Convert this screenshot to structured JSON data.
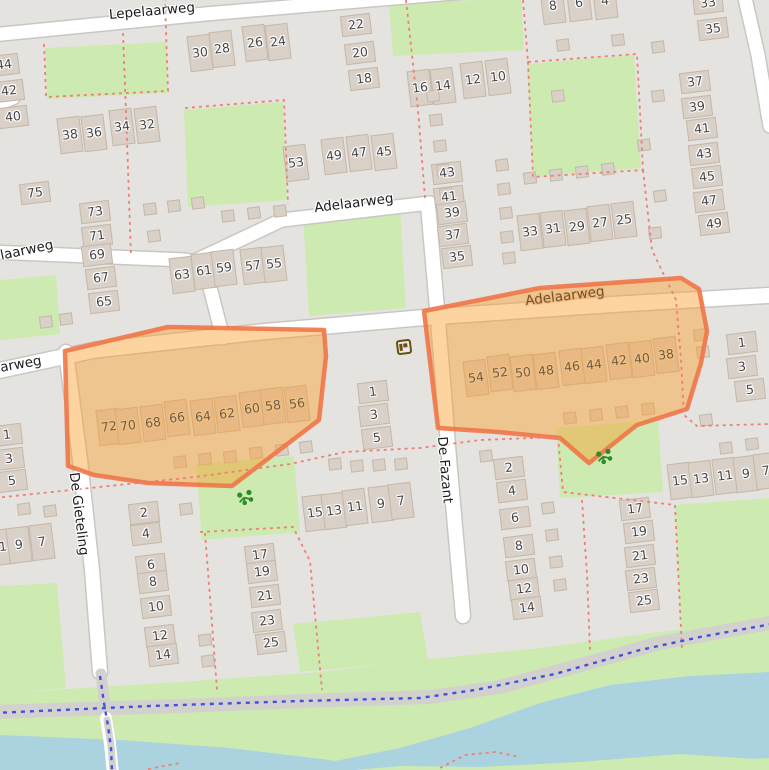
{
  "map": {
    "colors": {
      "bg": "#e4e3e0",
      "green": "#cdebb0",
      "water": "#aad3df",
      "building": "#d9d0c8",
      "building_stroke": "#c5b8a8",
      "road": "#ffffff",
      "road_casing": "#c9c7c3",
      "path_grey": "#d2d1cd",
      "dash_red": "#ee7f75",
      "dot_blue": "#4350dd",
      "orange_fill": "rgba(250,157,45,0.45)",
      "orange_stroke": "rgba(240,118,72,0.9)",
      "number": "#454545",
      "number_in_orange": "#6e5e45",
      "street": "#1c1c1c",
      "poi_brown": "#6b4f12",
      "playground_green": "#2e8b2b"
    },
    "street_labels": [
      {
        "t": "Lepelaarweg",
        "x": 152,
        "y": 12,
        "r": -5
      },
      {
        "t": "laarweg",
        "x": 27,
        "y": 251,
        "r": -12
      },
      {
        "t": "arweg",
        "x": 21,
        "y": 365,
        "r": -10
      },
      {
        "t": "Adelaarweg",
        "x": 354,
        "y": 204,
        "r": -7
      },
      {
        "t": "Adelaarweg",
        "x": 565,
        "y": 297,
        "r": -7,
        "o": 1
      },
      {
        "t": "De Gieteling",
        "x": 78,
        "y": 514,
        "r": 83
      },
      {
        "t": "De Fazant",
        "x": 444,
        "y": 470,
        "r": 85
      }
    ],
    "house_numbers": [
      [
        "44",
        4,
        65,
        "v",
        0
      ],
      [
        "42",
        9,
        91,
        "v",
        0
      ],
      [
        "40",
        13,
        117,
        "v",
        0
      ],
      [
        "38",
        70,
        135,
        "h",
        0
      ],
      [
        "36",
        94,
        133,
        "h",
        0
      ],
      [
        "34",
        122,
        127,
        "h",
        0
      ],
      [
        "32",
        147,
        125,
        "h",
        0
      ],
      [
        "30",
        200,
        53,
        "h",
        0
      ],
      [
        "28",
        222,
        49,
        "h",
        0
      ],
      [
        "26",
        255,
        43,
        "h",
        0
      ],
      [
        "24",
        278,
        42,
        "h",
        0
      ],
      [
        "22",
        356,
        25,
        "v",
        0
      ],
      [
        "20",
        360,
        53,
        "v",
        0
      ],
      [
        "18",
        364,
        79,
        "v",
        0
      ],
      [
        "75",
        35,
        193,
        "v",
        0
      ],
      [
        "73",
        95,
        212,
        "v",
        0
      ],
      [
        "71",
        97,
        236,
        "v",
        0
      ],
      [
        "69",
        97,
        255,
        "v",
        0
      ],
      [
        "67",
        101,
        278,
        "v",
        0
      ],
      [
        "65",
        104,
        302,
        "v",
        0
      ],
      [
        "63",
        182,
        275,
        "h",
        0
      ],
      [
        "61",
        204,
        271,
        "h",
        0
      ],
      [
        "59",
        224,
        268,
        "h",
        0
      ],
      [
        "57",
        253,
        266,
        "h",
        0
      ],
      [
        "55",
        274,
        264,
        "h",
        0
      ],
      [
        "53",
        296,
        163,
        "h",
        0
      ],
      [
        "49",
        334,
        156,
        "h",
        0
      ],
      [
        "47",
        359,
        153,
        "h",
        0
      ],
      [
        "45",
        384,
        152,
        "h",
        0
      ],
      [
        "16",
        420,
        88,
        "h",
        0
      ],
      [
        "14",
        443,
        86,
        "h",
        0
      ],
      [
        "12",
        473,
        80,
        "h",
        0
      ],
      [
        "10",
        498,
        77,
        "h",
        0
      ],
      [
        "8",
        553,
        6,
        "h",
        0
      ],
      [
        "6",
        579,
        3,
        "h",
        0
      ],
      [
        "4",
        605,
        1,
        "h",
        0
      ],
      [
        "43",
        447,
        173,
        "v",
        0
      ],
      [
        "41",
        449,
        197,
        "v",
        0
      ],
      [
        "39",
        452,
        213,
        "v",
        0
      ],
      [
        "37",
        453,
        235,
        "v",
        0
      ],
      [
        "35",
        457,
        257,
        "v",
        0
      ],
      [
        "33",
        530,
        232,
        "h",
        0
      ],
      [
        "31",
        553,
        229,
        "h",
        0
      ],
      [
        "29",
        577,
        227,
        "h",
        0
      ],
      [
        "27",
        600,
        223,
        "h",
        0
      ],
      [
        "25",
        624,
        220,
        "h",
        0
      ],
      [
        "33",
        708,
        3,
        "v",
        0
      ],
      [
        "35",
        713,
        29,
        "v",
        0
      ],
      [
        "37",
        695,
        82,
        "v",
        0
      ],
      [
        "39",
        697,
        107,
        "v",
        0
      ],
      [
        "41",
        702,
        129,
        "v",
        0
      ],
      [
        "43",
        704,
        154,
        "v",
        0
      ],
      [
        "45",
        707,
        177,
        "v",
        0
      ],
      [
        "47",
        709,
        201,
        "v",
        0
      ],
      [
        "49",
        714,
        224,
        "v",
        0
      ],
      [
        "72",
        109,
        427,
        "h",
        1
      ],
      [
        "70",
        128,
        426,
        "h",
        1
      ],
      [
        "68",
        153,
        423,
        "h",
        1
      ],
      [
        "66",
        177,
        418,
        "h",
        1
      ],
      [
        "64",
        203,
        417,
        "h",
        1
      ],
      [
        "62",
        227,
        414,
        "h",
        1
      ],
      [
        "60",
        252,
        409,
        "h",
        1
      ],
      [
        "58",
        273,
        406,
        "h",
        1
      ],
      [
        "56",
        297,
        404,
        "h",
        1
      ],
      [
        "54",
        476,
        378,
        "h",
        1
      ],
      [
        "52",
        500,
        373,
        "h",
        1
      ],
      [
        "50",
        523,
        373,
        "h",
        1
      ],
      [
        "48",
        546,
        371,
        "h",
        1
      ],
      [
        "46",
        572,
        367,
        "h",
        1
      ],
      [
        "44",
        594,
        365,
        "h",
        1
      ],
      [
        "42",
        619,
        361,
        "h",
        1
      ],
      [
        "40",
        642,
        359,
        "h",
        1
      ],
      [
        "38",
        666,
        355,
        "h",
        1
      ],
      [
        "1",
        373,
        392,
        "v",
        0
      ],
      [
        "3",
        374,
        415,
        "v",
        0
      ],
      [
        "5",
        377,
        438,
        "v",
        0
      ],
      [
        "1",
        742,
        343,
        "v",
        0
      ],
      [
        "3",
        742,
        367,
        "v",
        0
      ],
      [
        "5",
        750,
        390,
        "v",
        0
      ],
      [
        "1",
        7,
        435,
        "v",
        0
      ],
      [
        "3",
        9,
        459,
        "v",
        0
      ],
      [
        "5",
        12,
        481,
        "v",
        0
      ],
      [
        "1",
        3,
        547,
        "h",
        0
      ],
      [
        "9",
        19,
        545,
        "h",
        0
      ],
      [
        "7",
        42,
        542,
        "h",
        0
      ],
      [
        "2",
        144,
        513,
        "v",
        0
      ],
      [
        "4",
        146,
        534,
        "v",
        0
      ],
      [
        "6",
        151,
        565,
        "v",
        0
      ],
      [
        "8",
        153,
        582,
        "v",
        0
      ],
      [
        "10",
        156,
        607,
        "v",
        0
      ],
      [
        "12",
        160,
        636,
        "v",
        0
      ],
      [
        "14",
        163,
        655,
        "v",
        0
      ],
      [
        "15",
        315,
        513,
        "h",
        0
      ],
      [
        "13",
        334,
        511,
        "h",
        0
      ],
      [
        "11",
        355,
        507,
        "h",
        0
      ],
      [
        "9",
        381,
        504,
        "h",
        0
      ],
      [
        "7",
        401,
        501,
        "h",
        0
      ],
      [
        "17",
        260,
        555,
        "v",
        0
      ],
      [
        "19",
        262,
        572,
        "v",
        0
      ],
      [
        "21",
        265,
        596,
        "v",
        0
      ],
      [
        "23",
        267,
        621,
        "v",
        0
      ],
      [
        "25",
        271,
        643,
        "v",
        0
      ],
      [
        "2",
        509,
        468,
        "v",
        0
      ],
      [
        "4",
        512,
        491,
        "v",
        0
      ],
      [
        "6",
        515,
        518,
        "v",
        0
      ],
      [
        "8",
        519,
        546,
        "v",
        0
      ],
      [
        "10",
        521,
        570,
        "v",
        0
      ],
      [
        "12",
        524,
        589,
        "v",
        0
      ],
      [
        "14",
        527,
        608,
        "v",
        0
      ],
      [
        "17",
        635,
        509,
        "v",
        0
      ],
      [
        "19",
        639,
        532,
        "v",
        0
      ],
      [
        "21",
        640,
        556,
        "v",
        0
      ],
      [
        "23",
        641,
        579,
        "v",
        0
      ],
      [
        "25",
        644,
        601,
        "v",
        0
      ],
      [
        "15",
        680,
        481,
        "h",
        0
      ],
      [
        "13",
        701,
        479,
        "h",
        0
      ],
      [
        "11",
        725,
        476,
        "h",
        0
      ],
      [
        "9",
        746,
        474,
        "h",
        0
      ],
      [
        "7",
        766,
        471,
        "h",
        0
      ]
    ],
    "sheds": [
      [
        150,
        209
      ],
      [
        174,
        206
      ],
      [
        198,
        203
      ],
      [
        228,
        216
      ],
      [
        254,
        213
      ],
      [
        280,
        211
      ],
      [
        154,
        236
      ],
      [
        433,
        96
      ],
      [
        436,
        120
      ],
      [
        440,
        146
      ],
      [
        443,
        170
      ],
      [
        446,
        194
      ],
      [
        563,
        45
      ],
      [
        618,
        40
      ],
      [
        658,
        47
      ],
      [
        658,
        96
      ],
      [
        558,
        96
      ],
      [
        644,
        145
      ],
      [
        660,
        196
      ],
      [
        655,
        233
      ],
      [
        530,
        178
      ],
      [
        556,
        175
      ],
      [
        582,
        172
      ],
      [
        608,
        169
      ],
      [
        502,
        165
      ],
      [
        504,
        189
      ],
      [
        506,
        213
      ],
      [
        507,
        237
      ],
      [
        509,
        258
      ],
      [
        335,
        464
      ],
      [
        357,
        466
      ],
      [
        379,
        465
      ],
      [
        401,
        464
      ],
      [
        180,
        462
      ],
      [
        205,
        459
      ],
      [
        230,
        457
      ],
      [
        256,
        453
      ],
      [
        282,
        450
      ],
      [
        306,
        447
      ],
      [
        570,
        418
      ],
      [
        596,
        415
      ],
      [
        622,
        412
      ],
      [
        648,
        409
      ],
      [
        700,
        335
      ],
      [
        703,
        352
      ],
      [
        726,
        448
      ],
      [
        752,
        444
      ],
      [
        706,
        420
      ],
      [
        24,
        509
      ],
      [
        50,
        511
      ],
      [
        186,
        509
      ],
      [
        548,
        508
      ],
      [
        552,
        535
      ],
      [
        556,
        562
      ],
      [
        560,
        585
      ],
      [
        486,
        456
      ],
      [
        205,
        640
      ],
      [
        208,
        661
      ],
      [
        46,
        322
      ],
      [
        66,
        319
      ]
    ],
    "icons": [
      {
        "name": "postbox-icon",
        "x": 404,
        "y": 347
      },
      {
        "name": "playground-icon",
        "x": 245,
        "y": 497
      },
      {
        "name": "playground-icon",
        "x": 604,
        "y": 456
      }
    ]
  }
}
